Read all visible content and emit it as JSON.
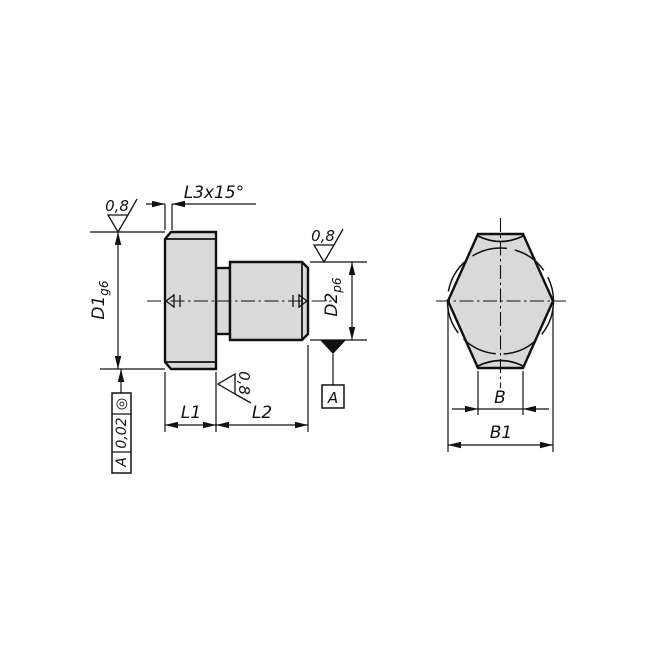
{
  "side_view": {
    "chamfer_dim": "L3x15°",
    "roughness_head_top": "0,8",
    "roughness_shaft_top": "0,8",
    "roughness_face": "0,8",
    "dim_d1": {
      "main": "D1",
      "tol": "g6"
    },
    "dim_d2": {
      "main": "D2",
      "tol": "p6"
    },
    "dim_l1": "L1",
    "dim_l2": "L2",
    "datum_label": "A",
    "tolerance_frame": {
      "symbol": "◎",
      "tolerance": "0,02",
      "datum": "A"
    }
  },
  "end_view": {
    "dim_b": "B",
    "dim_b1": "B1"
  },
  "colors": {
    "outline": "#111111",
    "part_fill": "#d9d9d9",
    "background": "#ffffff"
  }
}
